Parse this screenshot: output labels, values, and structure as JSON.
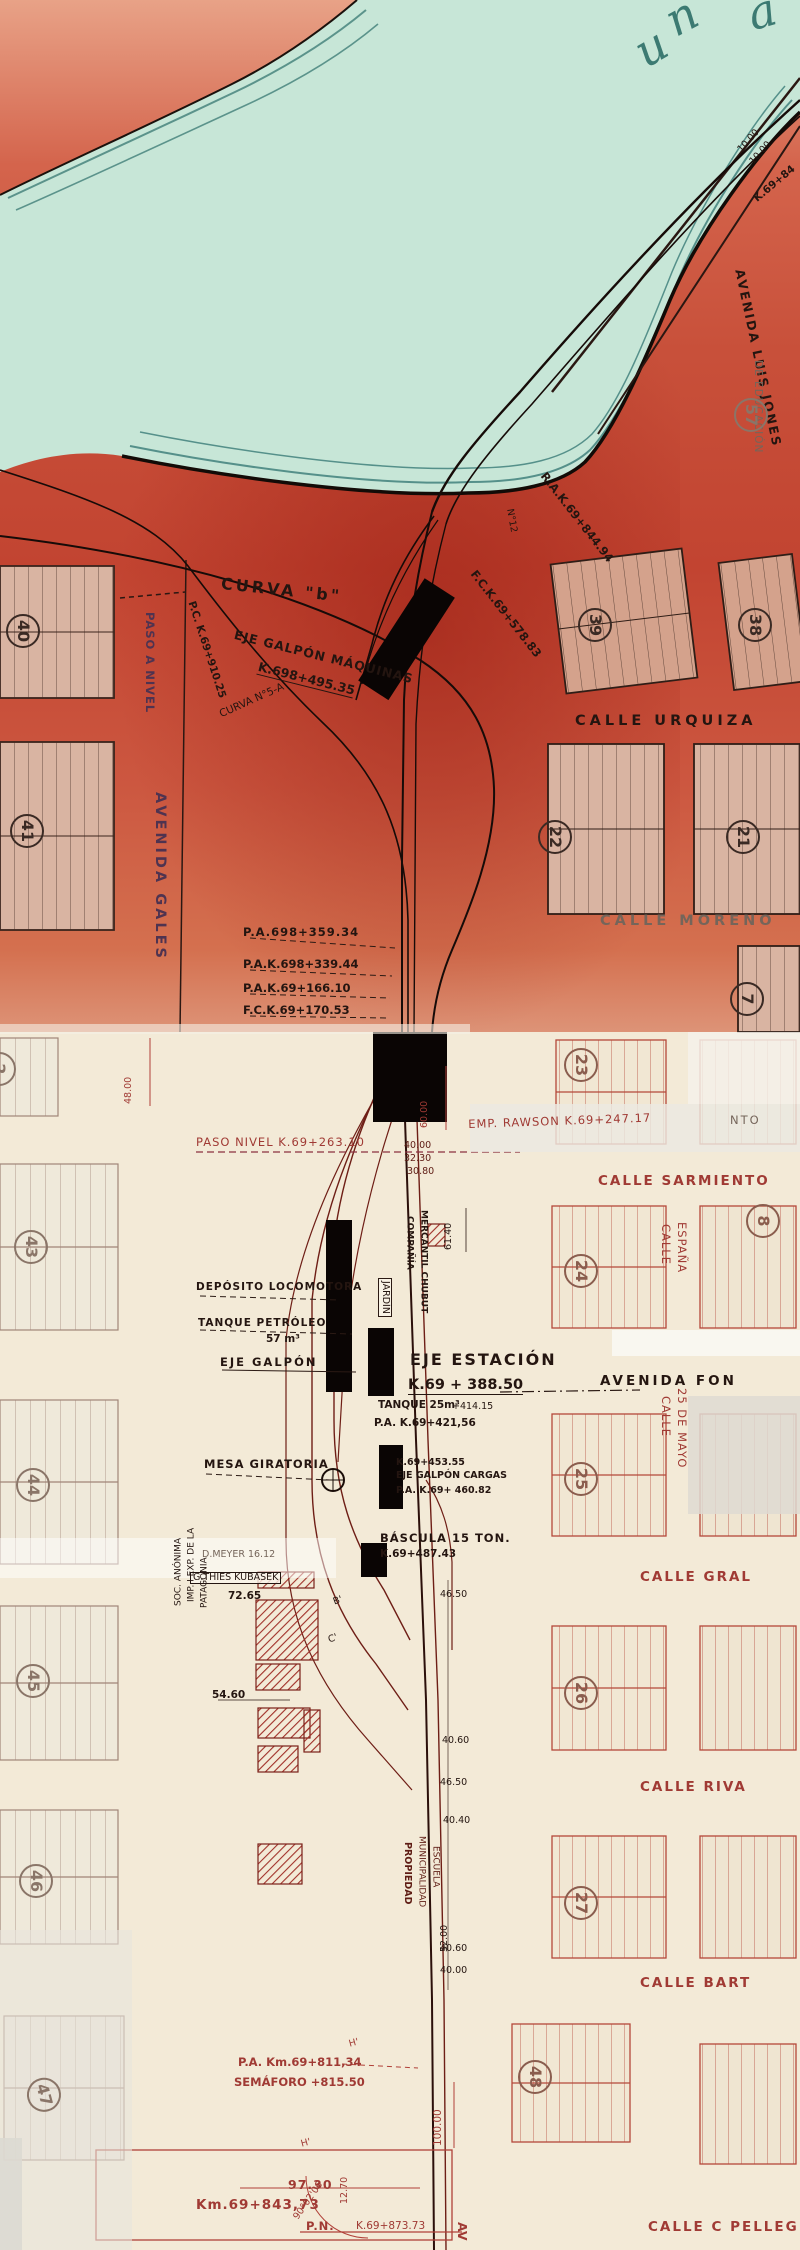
{
  "map": {
    "palette": {
      "water": "#c7e6d7",
      "water_line": "#5b938b",
      "land_upper": "#c24431",
      "land_lower": "#f3ead7",
      "ink": "#241510",
      "red_pencil": "#a03a34"
    },
    "labels": [
      {
        "text": "u",
        "name": "water-name-letter",
        "x": 626,
        "y": 34,
        "cls": "water-letter",
        "rot": -30
      },
      {
        "text": "n",
        "name": "water-name-letter",
        "x": 657,
        "y": 2,
        "cls": "water-letter",
        "rot": -28
      },
      {
        "text": "a",
        "name": "water-name-letter",
        "x": 742,
        "y": -8,
        "cls": "water-letter",
        "rot": -16
      },
      {
        "text": "10.00",
        "name": "dimension-label",
        "x": 736,
        "y": 148,
        "cls": "s9 cInk",
        "rot": -48
      },
      {
        "text": "10.00",
        "name": "dimension-label",
        "x": 748,
        "y": 160,
        "cls": "s9 cInk",
        "rot": -48
      },
      {
        "text": "K.69+84",
        "name": "km-marker",
        "x": 752,
        "y": 196,
        "cls": "s10 cInk bold",
        "rot": -40
      },
      {
        "text": "AVENIDA LUIS JONES",
        "name": "street-label",
        "x": 746,
        "y": 268,
        "cls": "s12 cInk sp2 bold",
        "rot": 78
      },
      {
        "text": "DE EDUCACIÓN",
        "name": "street-label",
        "x": 752,
        "y": 360,
        "cls": "s10 cGray sp1 vert"
      },
      {
        "text": "57",
        "name": "block-number",
        "x": 768,
        "y": 398,
        "cls": "blk blkGray lbl2",
        "rot": 90
      },
      {
        "text": "CURVA \"b\"",
        "name": "annotation",
        "x": 222,
        "y": 576,
        "cls": "s15 cInk sp3 bold",
        "rot": 6
      },
      {
        "text": "EJE GALPÓN MÁQUINAS",
        "name": "facility-label",
        "x": 236,
        "y": 628,
        "cls": "s12 cInk sp1 bold",
        "rot": 14
      },
      {
        "text": "K.698+495.35",
        "name": "km-marker",
        "x": 260,
        "y": 660,
        "cls": "s12 cInk ul bold",
        "rot": 14
      },
      {
        "text": "P.C. K.69+910.25",
        "name": "km-marker",
        "x": 196,
        "y": 600,
        "cls": "s10 cInk bold",
        "rot": 72
      },
      {
        "text": "CURVA N°5-A",
        "name": "annotation",
        "x": 218,
        "y": 710,
        "cls": "s10 cInk",
        "rot": -24
      },
      {
        "text": "R.A.K.69+844.94",
        "name": "km-marker",
        "x": 548,
        "y": 470,
        "cls": "s11 cInk bold",
        "rot": 52
      },
      {
        "text": "F.C.K.69+578.83",
        "name": "km-marker",
        "x": 478,
        "y": 568,
        "cls": "s11 cInk bold",
        "rot": 52
      },
      {
        "text": "N°12",
        "name": "track-point-label",
        "x": 514,
        "y": 508,
        "cls": "s9 cInk",
        "rot": 80
      },
      {
        "text": "PASO A NIVEL",
        "name": "annotation",
        "x": 144,
        "y": 612,
        "cls": "s11 cPurple sp1 vert bold"
      },
      {
        "text": "AVENIDA GALES",
        "name": "street-label",
        "x": 152,
        "y": 792,
        "cls": "s14 cPurple sp3 vert bold"
      },
      {
        "text": "40",
        "name": "block-number",
        "x": 40,
        "y": 614,
        "cls": "blk blkDark",
        "rot": 90
      },
      {
        "text": "41",
        "name": "block-number",
        "x": 44,
        "y": 814,
        "cls": "blk blkDark",
        "rot": 90
      },
      {
        "text": "39",
        "name": "block-number",
        "x": 612,
        "y": 608,
        "cls": "blk blkDark",
        "rot": 90
      },
      {
        "text": "38",
        "name": "block-number",
        "x": 772,
        "y": 608,
        "cls": "blk blkDark",
        "rot": 90
      },
      {
        "text": "22",
        "name": "block-number",
        "x": 572,
        "y": 820,
        "cls": "blk blkDark",
        "rot": 90
      },
      {
        "text": "21",
        "name": "block-number",
        "x": 760,
        "y": 820,
        "cls": "blk blkDark",
        "rot": 90
      },
      {
        "text": "7",
        "name": "block-number",
        "x": 764,
        "y": 982,
        "cls": "blk blkDark",
        "rot": 90
      },
      {
        "text": "CALLE  URQUIZA",
        "name": "street-label",
        "x": 575,
        "y": 714,
        "cls": "s14 cInk sp4 bold"
      },
      {
        "text": "CALLE  MORENO",
        "name": "street-label",
        "x": 600,
        "y": 914,
        "cls": "s14 cGray sp4 bold"
      },
      {
        "text": "P.A.698+359.34",
        "name": "km-marker",
        "x": 243,
        "y": 926,
        "cls": "s11 cInk sp1 bold"
      },
      {
        "text": "P.A.K.698+339.44",
        "name": "km-marker",
        "x": 243,
        "y": 958,
        "cls": "s11 cInk bold"
      },
      {
        "text": "P.A.K.69+166.10",
        "name": "km-marker",
        "x": 243,
        "y": 982,
        "cls": "s11 cInk bold"
      },
      {
        "text": "F.C.K.69+170.53",
        "name": "km-marker",
        "x": 243,
        "y": 1004,
        "cls": "s11 cInk bold"
      },
      {
        "text": "48.00",
        "name": "dimension-label",
        "x": 134,
        "y": 1104,
        "cls": "s9 cRed vup"
      },
      {
        "text": "60.00",
        "name": "dimension-label",
        "x": 430,
        "y": 1128,
        "cls": "s9 cRed vup"
      },
      {
        "text": "PASO NIVEL K.69+263.10",
        "name": "km-marker",
        "x": 196,
        "y": 1136,
        "cls": "s11 cRed sp1"
      },
      {
        "text": "EMP. RAWSON K.69+247.17",
        "name": "km-marker",
        "x": 468,
        "y": 1118,
        "cls": "s11 cRed sp1",
        "rot": -2
      },
      {
        "text": "40.00",
        "name": "dimension-label",
        "x": 404,
        "y": 1141,
        "cls": "s9 cDkRed"
      },
      {
        "text": "32.30",
        "name": "dimension-label",
        "x": 404,
        "y": 1154,
        "cls": "s9 cDkRed"
      },
      {
        "text": "30.80",
        "name": "dimension-label",
        "x": 407,
        "y": 1167,
        "cls": "s9 cDkRed"
      },
      {
        "text": "NTO",
        "name": "street-label",
        "x": 730,
        "y": 1114,
        "cls": "s11 cGray sp2"
      },
      {
        "text": "CALLE SARMIENTO",
        "name": "street-label",
        "x": 598,
        "y": 1174,
        "cls": "s13 cRed sp2 bold"
      },
      {
        "text": "CALLE",
        "name": "street-label",
        "x": 660,
        "y": 1224,
        "cls": "s11 cRed vert sp1"
      },
      {
        "text": "ESPAÑA",
        "name": "street-label",
        "x": 676,
        "y": 1222,
        "cls": "s11 cRed vert sp1"
      },
      {
        "text": "23",
        "name": "block-number",
        "x": 598,
        "y": 1048,
        "cls": "blk blkRed",
        "rot": 90
      },
      {
        "text": "24",
        "name": "block-number",
        "x": 598,
        "y": 1254,
        "cls": "blk blkRed",
        "rot": 90
      },
      {
        "text": "8",
        "name": "block-number",
        "x": 780,
        "y": 1204,
        "cls": "blk blkRed",
        "rot": 90
      },
      {
        "text": "2",
        "name": "block-number",
        "x": 16,
        "y": 1052,
        "cls": "blk blkGray",
        "rot": 90
      },
      {
        "text": "COMPAÑÍA",
        "name": "property-label",
        "x": 404,
        "y": 1216,
        "cls": "s8 cInk vert bold"
      },
      {
        "text": "MERCANTIL CHUBUT",
        "name": "property-label",
        "x": 418,
        "y": 1210,
        "cls": "s8 cInk vert bold"
      },
      {
        "text": "JARDÍN",
        "name": "facility-label",
        "x": 378,
        "y": 1278,
        "cls": "s9 cInk vert wbox"
      },
      {
        "text": "61.40",
        "name": "dimension-label",
        "x": 454,
        "y": 1250,
        "cls": "s9 cInk vup"
      },
      {
        "text": "DEPÓSITO LOCOMOTORA",
        "name": "facility-label",
        "x": 196,
        "y": 1282,
        "cls": "s10 cInk sp1 bold"
      },
      {
        "text": "TANQUE PETRÓLEO",
        "name": "facility-label",
        "x": 198,
        "y": 1318,
        "cls": "s10 cInk sp1 bold"
      },
      {
        "text": "57 m³",
        "name": "facility-label",
        "x": 266,
        "y": 1334,
        "cls": "s10 cInk bold"
      },
      {
        "text": "EJE GALPÓN",
        "name": "facility-label",
        "x": 220,
        "y": 1356,
        "cls": "s11 cInk sp2 bold"
      },
      {
        "text": "EJE ESTACIÓN",
        "name": "facility-label",
        "x": 410,
        "y": 1352,
        "cls": "s15 cInk sp2 bold"
      },
      {
        "text": "K.69 + 388.50",
        "name": "km-marker",
        "x": 408,
        "y": 1378,
        "cls": "s14 cInk ul bold"
      },
      {
        "text": "AVENIDA FON",
        "name": "street-label",
        "x": 600,
        "y": 1374,
        "cls": "s13 cInk sp3 bold"
      },
      {
        "text": "TANQUE 25m³",
        "name": "facility-label",
        "x": 378,
        "y": 1400,
        "cls": "s10 cInk bold"
      },
      {
        "text": "+414.15",
        "name": "km-marker",
        "x": 452,
        "y": 1402,
        "cls": "s9 cInk"
      },
      {
        "text": "P.A. K.69+421,56",
        "name": "km-marker",
        "x": 374,
        "y": 1418,
        "cls": "s10 cInk bold"
      },
      {
        "text": "CALLE",
        "name": "street-label",
        "x": 660,
        "y": 1396,
        "cls": "s11 cRed vert sp1"
      },
      {
        "text": "25 DE MAYO",
        "name": "street-label",
        "x": 676,
        "y": 1388,
        "cls": "s11 cRed vert sp1"
      },
      {
        "text": "25",
        "name": "block-number",
        "x": 598,
        "y": 1462,
        "cls": "blk blkRed",
        "rot": 90
      },
      {
        "text": "K.69+453.55",
        "name": "km-marker",
        "x": 396,
        "y": 1458,
        "cls": "s9 cInk bold"
      },
      {
        "text": "EJE GALPÓN CARGAS",
        "name": "facility-label",
        "x": 396,
        "y": 1471,
        "cls": "s9 cInk bold"
      },
      {
        "text": "P.A. K.69+ 460.82",
        "name": "km-marker",
        "x": 396,
        "y": 1486,
        "cls": "s9 cInk bold"
      },
      {
        "text": "MESA GIRATORIA",
        "name": "facility-label",
        "x": 204,
        "y": 1458,
        "cls": "s11 cInk sp1 bold"
      },
      {
        "text": "BÁSCULA 15 TON.",
        "name": "facility-label",
        "x": 380,
        "y": 1532,
        "cls": "s11 cInk sp1 bold"
      },
      {
        "text": "K.69+487.43",
        "name": "km-marker",
        "x": 380,
        "y": 1549,
        "cls": "s10 cInk bold"
      },
      {
        "text": "D.MEYER 16.12",
        "name": "property-label",
        "x": 202,
        "y": 1550,
        "cls": "s9 cGray"
      },
      {
        "text": "G.THIES KUBASEK",
        "name": "property-label",
        "x": 190,
        "y": 1572,
        "cls": "s9 cInk boxed"
      },
      {
        "text": "72.65",
        "name": "dimension-label",
        "x": 228,
        "y": 1591,
        "cls": "s10 cInk bold"
      },
      {
        "text": "46.50",
        "name": "dimension-label",
        "x": 440,
        "y": 1590,
        "cls": "s9 cInk"
      },
      {
        "text": "SOC. ANÓNIMA",
        "name": "property-label",
        "x": 184,
        "y": 1606,
        "cls": "s8 cInk vup"
      },
      {
        "text": "IMP. I EXP. DE LA",
        "name": "property-label",
        "x": 197,
        "y": 1602,
        "cls": "s8 cInk vup"
      },
      {
        "text": "PATAGONIA",
        "name": "property-label",
        "x": 210,
        "y": 1608,
        "cls": "s8 cInk vup"
      },
      {
        "text": "B'",
        "name": "track-point-label",
        "x": 332,
        "y": 1598,
        "cls": "s9 cInk",
        "rot": -20
      },
      {
        "text": "C'",
        "name": "track-point-label",
        "x": 327,
        "y": 1636,
        "cls": "s9 cInk",
        "rot": -20
      },
      {
        "text": "54.60",
        "name": "dimension-label",
        "x": 212,
        "y": 1690,
        "cls": "s10 cInk bold"
      },
      {
        "text": "CALLE GRAL",
        "name": "street-label",
        "x": 640,
        "y": 1570,
        "cls": "s13 cRed sp2 bold"
      },
      {
        "text": "26",
        "name": "block-number",
        "x": 598,
        "y": 1676,
        "cls": "blk blkRed",
        "rot": 90
      },
      {
        "text": "40.60",
        "name": "dimension-label",
        "x": 442,
        "y": 1736,
        "cls": "s9 cInk"
      },
      {
        "text": "46.50",
        "name": "dimension-label",
        "x": 440,
        "y": 1778,
        "cls": "s9 cInk"
      },
      {
        "text": "40.40",
        "name": "dimension-label",
        "x": 443,
        "y": 1816,
        "cls": "s9 cInk"
      },
      {
        "text": "CALLE RIVA",
        "name": "street-label",
        "x": 640,
        "y": 1780,
        "cls": "s13 cRed sp2 bold"
      },
      {
        "text": "PROPIEDAD",
        "name": "property-label",
        "x": 402,
        "y": 1842,
        "cls": "s9 cDkRed vert bold"
      },
      {
        "text": "MUNICIPALIDAD",
        "name": "property-label",
        "x": 416,
        "y": 1836,
        "cls": "s8 cDkRed vert"
      },
      {
        "text": "ESCUELA",
        "name": "property-label",
        "x": 430,
        "y": 1846,
        "cls": "s8 cDkRed vert"
      },
      {
        "text": "27",
        "name": "block-number",
        "x": 598,
        "y": 1886,
        "cls": "blk blkRed",
        "rot": 90
      },
      {
        "text": "52.00",
        "name": "dimension-label",
        "x": 450,
        "y": 1952,
        "cls": "s9 cInk vup"
      },
      {
        "text": "40.60",
        "name": "dimension-label",
        "x": 440,
        "y": 1944,
        "cls": "s9 cInk"
      },
      {
        "text": "40.00",
        "name": "dimension-label",
        "x": 440,
        "y": 1966,
        "cls": "s9 cInk"
      },
      {
        "text": "CALLE BART",
        "name": "street-label",
        "x": 640,
        "y": 1976,
        "cls": "s13 cRed sp2 bold"
      },
      {
        "text": "48",
        "name": "block-number",
        "x": 552,
        "y": 2060,
        "cls": "blk blkRed",
        "rot": 90
      },
      {
        "text": "P.A. Km.69+811,34",
        "name": "km-marker",
        "x": 238,
        "y": 2056,
        "cls": "s11 cRed bold"
      },
      {
        "text": "SEMÁFORO +815.50",
        "name": "km-marker",
        "x": 234,
        "y": 2076,
        "cls": "s11 cRed bold"
      },
      {
        "text": "100.00",
        "name": "dimension-label",
        "x": 444,
        "y": 2146,
        "cls": "s10 cRed vup"
      },
      {
        "text": "H'",
        "name": "track-point-label",
        "x": 348,
        "y": 2040,
        "cls": "s9 cRed",
        "rot": -15
      },
      {
        "text": "H'",
        "name": "track-point-label",
        "x": 300,
        "y": 2140,
        "cls": "s9 cRed",
        "rot": -15
      },
      {
        "text": "97.30",
        "name": "dimension-label",
        "x": 288,
        "y": 2178,
        "cls": "s12 cRed sp1 bold"
      },
      {
        "text": "90°02'06",
        "name": "dimension-label",
        "x": 292,
        "y": 2216,
        "cls": "s9 cRed",
        "rot": -55
      },
      {
        "text": "12.70",
        "name": "dimension-label",
        "x": 350,
        "y": 2204,
        "cls": "s9 cRed vup"
      },
      {
        "text": "Km.69+843,73",
        "name": "km-marker",
        "x": 196,
        "y": 2198,
        "cls": "s13 cRed sp1 bold"
      },
      {
        "text": "P.N.",
        "name": "annotation",
        "x": 306,
        "y": 2220,
        "cls": "s11 cRed sp1 bold"
      },
      {
        "text": "K.69+873.73",
        "name": "km-marker",
        "x": 356,
        "y": 2221,
        "cls": "s10 cRed"
      },
      {
        "text": "AV",
        "name": "street-label",
        "x": 456,
        "y": 2222,
        "cls": "s12 cRed vert bold"
      },
      {
        "text": "CALLE C PELLEG",
        "name": "street-label",
        "x": 648,
        "y": 2220,
        "cls": "s13 cRed sp2 bold"
      },
      {
        "text": "43",
        "name": "block-number",
        "x": 48,
        "y": 1230,
        "cls": "blk blkGray",
        "rot": 90
      },
      {
        "text": "44",
        "name": "block-number",
        "x": 50,
        "y": 1468,
        "cls": "blk blkGray",
        "rot": 90
      },
      {
        "text": "45",
        "name": "block-number",
        "x": 50,
        "y": 1664,
        "cls": "blk blkGray",
        "rot": 90
      },
      {
        "text": "46",
        "name": "block-number",
        "x": 53,
        "y": 1864,
        "cls": "blk blkGray",
        "rot": 90
      },
      {
        "text": "47",
        "name": "block-number",
        "x": 56,
        "y": 2074,
        "cls": "blk blkGray",
        "rot": 75
      }
    ]
  }
}
